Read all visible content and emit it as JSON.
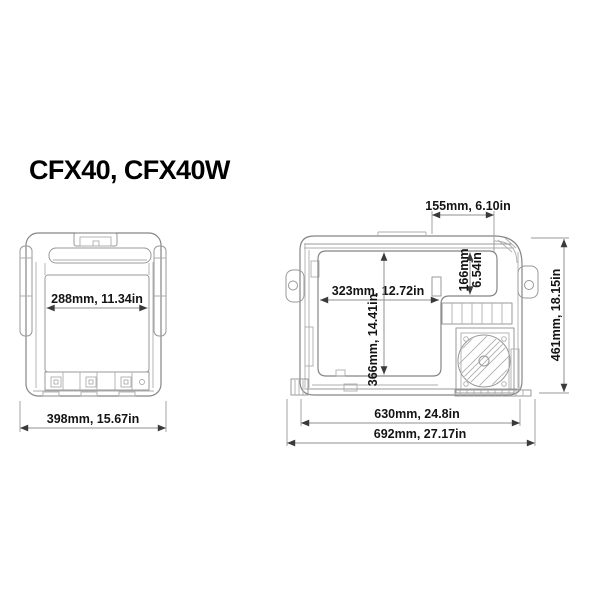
{
  "title": "CFX40, CFX40W",
  "colors": {
    "background": "#ffffff",
    "drawing_line": "#858585",
    "dimension_line": "#8f8f8f",
    "text": "#141414"
  },
  "front_view": {
    "dims": {
      "inner_width": "288mm, 11.34in",
      "overall_width": "398mm, 15.67in"
    }
  },
  "side_view": {
    "dims": {
      "top_section_length": "155mm, 6.10in",
      "step_depth_mm": "166mm",
      "step_depth_in": "6.54in",
      "compartment_length": "323mm, 12.72in",
      "compartment_depth": "366mm, 14.41in",
      "overall_height": "461mm, 18.15in",
      "base_length": "630mm, 24.8in",
      "overall_length": "692mm, 27.17in"
    }
  }
}
